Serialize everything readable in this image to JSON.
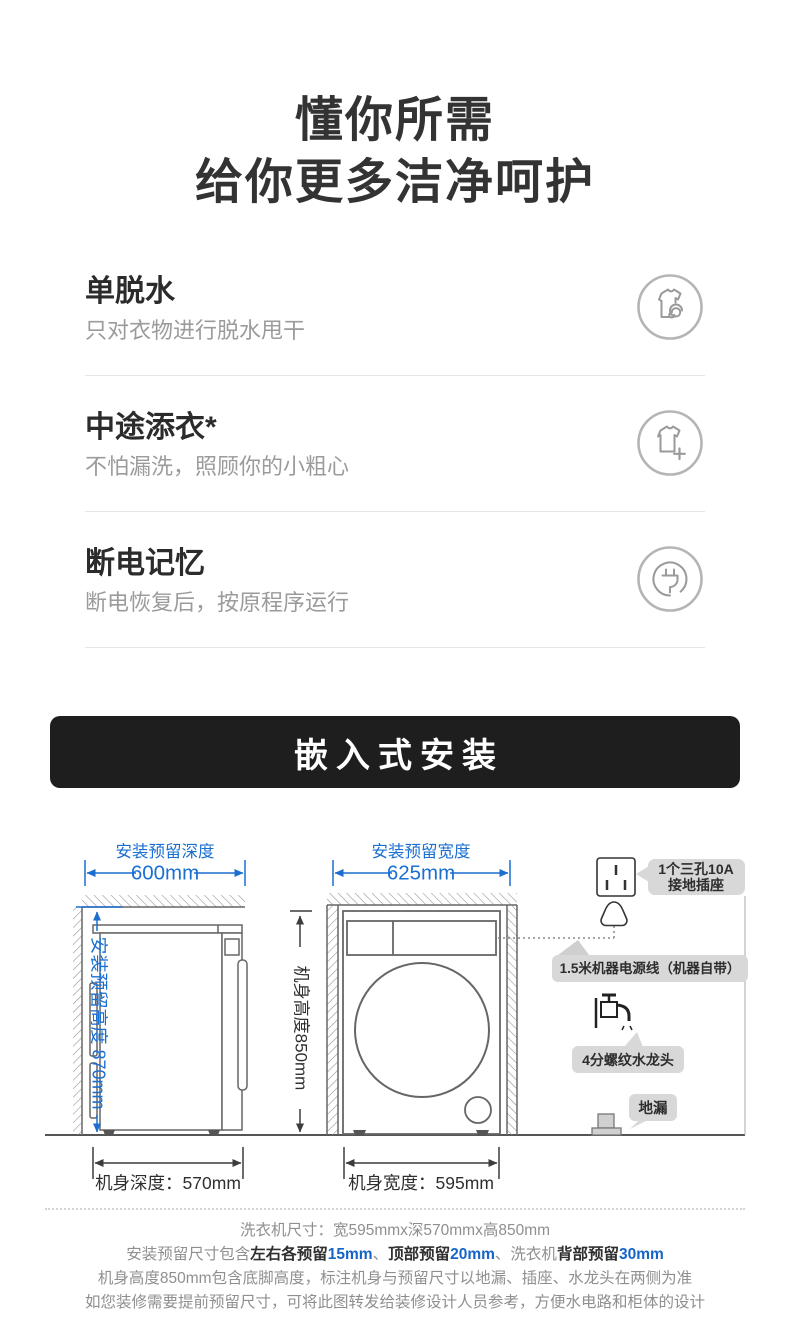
{
  "header": {
    "title_line1": "懂你所需",
    "title_line2": "给你更多洁净呵护"
  },
  "features": [
    {
      "title": "单脱水",
      "desc": "只对衣物进行脱水甩干",
      "icon": "shirt-spin-icon"
    },
    {
      "title": "中途添衣*",
      "desc": "不怕漏洗，照顾你的小粗心",
      "icon": "shirt-add-icon"
    },
    {
      "title": "断电记忆",
      "desc": "断电恢复后，按原程序运行",
      "icon": "power-plug-icon"
    }
  ],
  "banner": {
    "label": "嵌入式安装",
    "bg_color": "#1e1e1e",
    "text_color": "#ffffff"
  },
  "diagram": {
    "accent_blue": "#1b6fd1",
    "line_gray": "#666666",
    "side_view": {
      "top_label": "安装预留深度",
      "top_value": "600mm",
      "left_label": "安装预留高度 870mm",
      "bottom_label": "机身深度：570mm"
    },
    "front_view": {
      "top_label": "安装预留宽度",
      "top_value": "625mm",
      "left_label": "机身高度850mm",
      "bottom_label": "机身宽度：595mm"
    },
    "annotations": {
      "socket_line1": "1个三孔10A",
      "socket_line2": "接地插座",
      "power_cord": "1.5米机器电源线（机器自带）",
      "faucet": "4分螺纹水龙头",
      "floor_drain": "地漏"
    }
  },
  "footer": {
    "line1": "洗衣机尺寸：宽595mmx深570mmx高850mm",
    "line2_parts": [
      {
        "text": "安装预留尺寸包含",
        "style": "gray"
      },
      {
        "text": "左右各预留",
        "style": "bold"
      },
      {
        "text": "15mm",
        "style": "blue"
      },
      {
        "text": "、",
        "style": "gray"
      },
      {
        "text": "顶部预留",
        "style": "bold"
      },
      {
        "text": "20mm",
        "style": "blue"
      },
      {
        "text": "、洗衣机",
        "style": "gray"
      },
      {
        "text": "背部预留",
        "style": "bold"
      },
      {
        "text": "30mm",
        "style": "blue"
      }
    ],
    "line3": "机身高度850mm包含底脚高度，标注机身与预留尺寸以地漏、插座、水龙头在两侧为准",
    "line4": "如您装修需要提前预留尺寸，可将此图转发给装修设计人员参考，方便水电路和柜体的设计"
  }
}
